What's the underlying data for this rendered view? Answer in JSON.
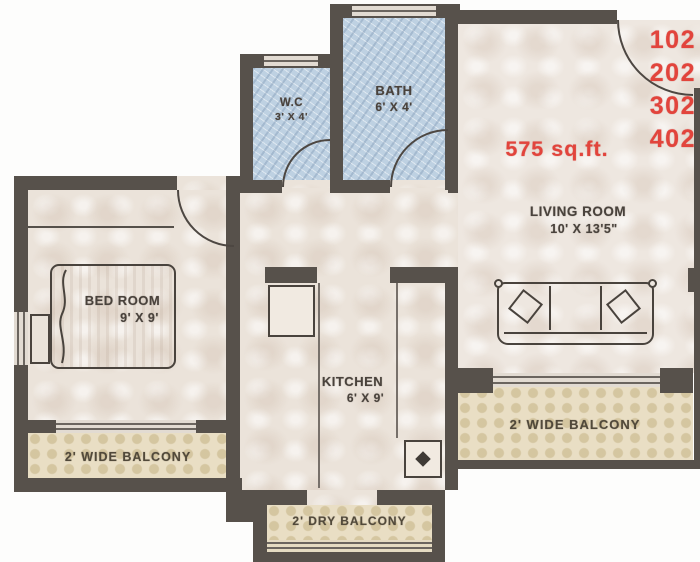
{
  "floor_plan": {
    "area_label": "575 sq.ft.",
    "unit_numbers": [
      "102",
      "202",
      "302",
      "402"
    ],
    "rooms": {
      "living_room": {
        "label": "LIVING ROOM",
        "dimensions": "10' X 13'5\""
      },
      "bed_room": {
        "label": "BED ROOM",
        "dimensions": "9' X 9'"
      },
      "kitchen": {
        "label": "KITCHEN",
        "dimensions": "6' X 9'"
      },
      "bath": {
        "label": "BATH",
        "dimensions": "6' X 4'"
      },
      "wc": {
        "label": "W.C",
        "dimensions": "3' X 4'"
      },
      "balcony_left": {
        "label": "2' WIDE BALCONY"
      },
      "balcony_right": {
        "label": "2' WIDE BALCONY"
      },
      "dry_balcony": {
        "label": "2' DRY BALCONY"
      }
    },
    "colors": {
      "wall": "#57514b",
      "bath_tile": "#bed1e2",
      "floor": "#ebe3da",
      "balcony_floor": "#e9dec4",
      "accent_red": "#e2443c",
      "label_text": "#49423c"
    }
  }
}
